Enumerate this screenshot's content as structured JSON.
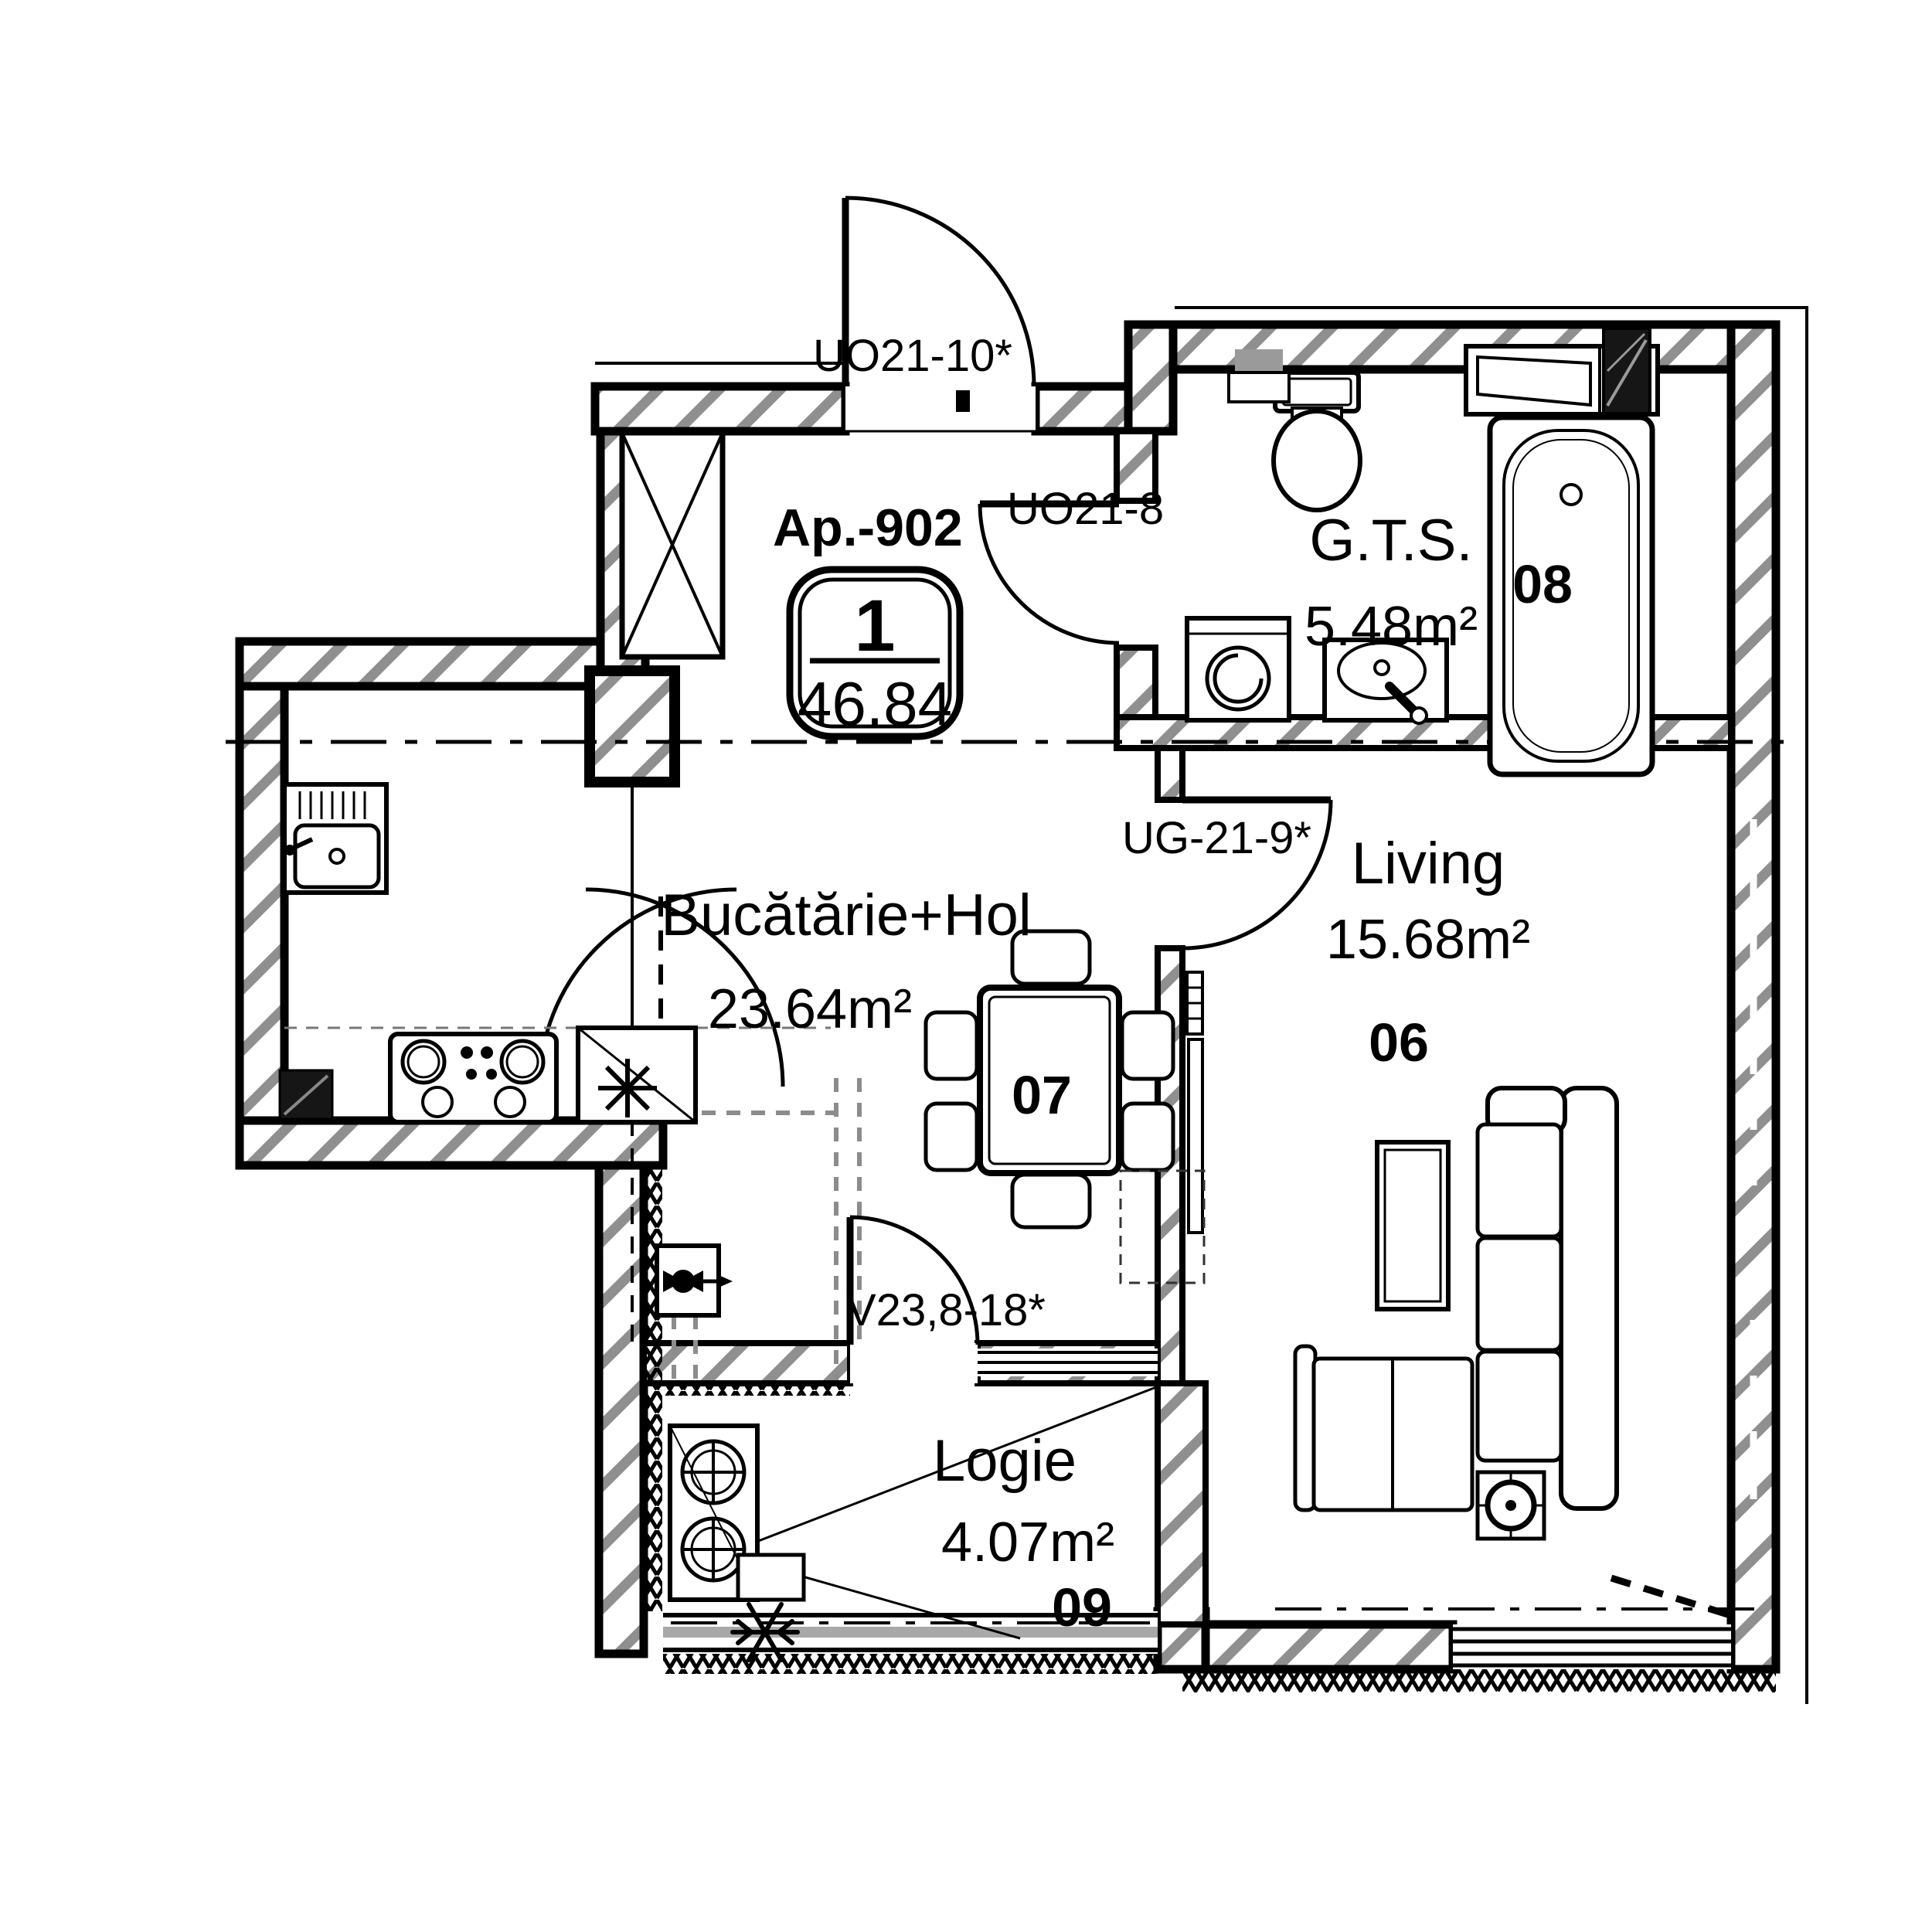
{
  "plan": {
    "apartment": {
      "label": "Ap.-902",
      "rooms_count": "1",
      "total_area": "46.84"
    },
    "rooms": [
      {
        "id": "kitchen-hall",
        "name": "Bucătărie+Hol",
        "area": "23.64m²",
        "number": "07"
      },
      {
        "id": "living",
        "name": "Living",
        "area": "15.68m²",
        "number": "06"
      },
      {
        "id": "bathroom",
        "name": "G.T.S.",
        "area": "5.48m²",
        "number": "08"
      },
      {
        "id": "loggia",
        "name": "Logie",
        "area": "4.07m²",
        "number": "09"
      }
    ],
    "openings": [
      {
        "id": "entrance-door",
        "code": "UO21-10*"
      },
      {
        "id": "bathroom-door",
        "code": "UO21-8"
      },
      {
        "id": "living-door",
        "code": "UG-21-9*"
      },
      {
        "id": "balcony-door",
        "code": "V23,8-18*"
      }
    ],
    "fixtures": [
      "wardrobe",
      "refrigerator",
      "stove",
      "kitchen-sink",
      "dining-table",
      "chairs",
      "toilet",
      "washing-machine",
      "vanity-sink",
      "bathtub",
      "shelf",
      "vent-shaft",
      "corner-sofa",
      "coffee-table",
      "floor-lamp",
      "ac-outdoor-unit",
      "snowflake",
      "gas-meter",
      "radiator",
      "tv-panel"
    ],
    "colors": {
      "line": "#000000",
      "wall_hatch": "#8f8f8f",
      "glazing": "#a8a8a8",
      "pipes": "#8c8c8c"
    }
  }
}
